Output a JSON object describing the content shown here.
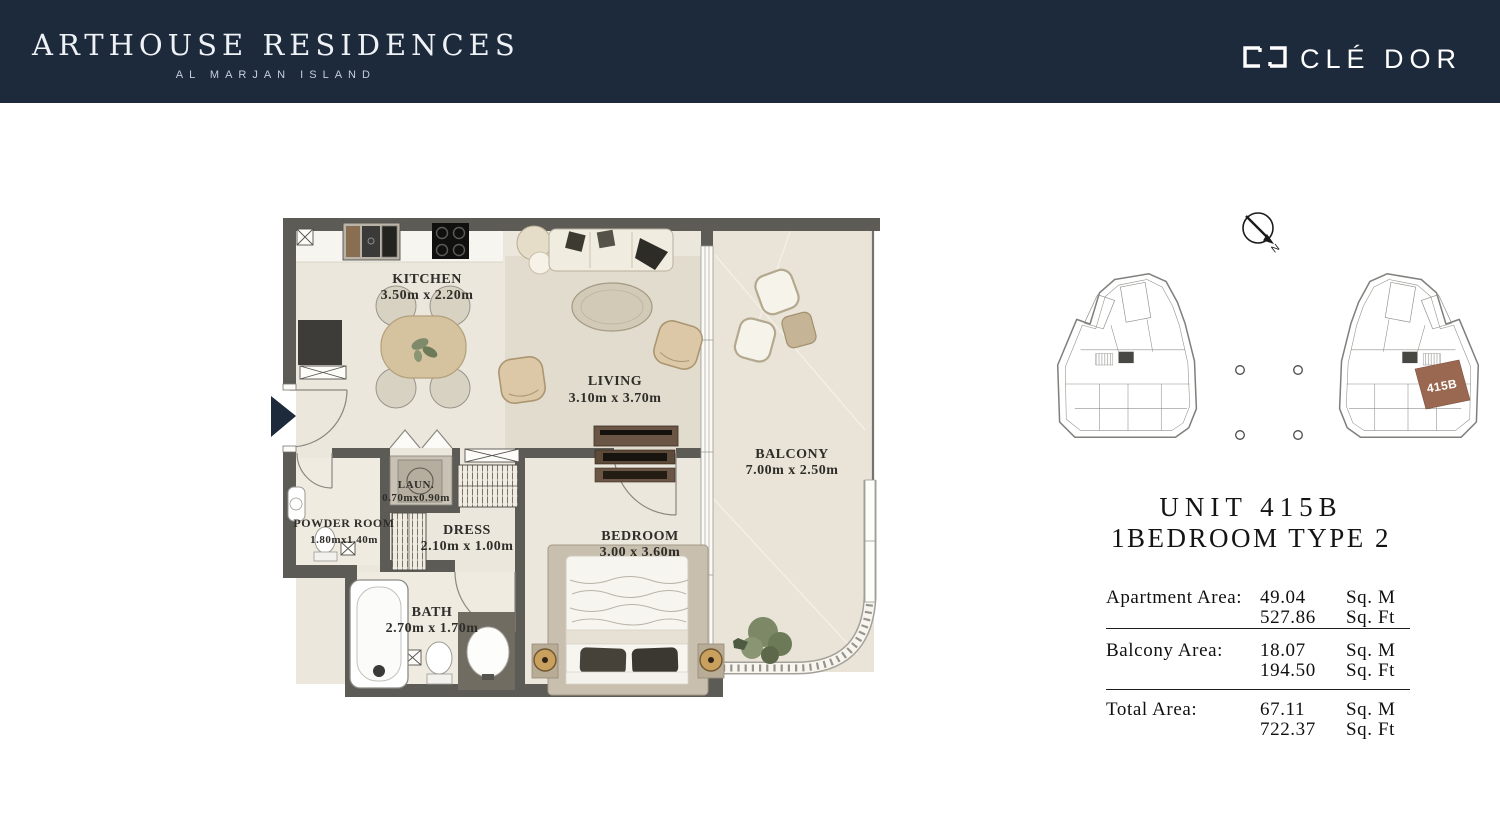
{
  "header": {
    "title": "ARTHOUSE RESIDENCES",
    "subtitle": "AL MARJAN ISLAND"
  },
  "brand": {
    "name": "CLÉ DOR"
  },
  "floorplan": {
    "compass_label": "N",
    "rooms": {
      "kitchen": {
        "name": "KITCHEN",
        "dims": "3.50m x 2.20m"
      },
      "living": {
        "name": "LIVING",
        "dims": "3.10m x 3.70m"
      },
      "balcony": {
        "name": "BALCONY",
        "dims": "7.00m x 2.50m"
      },
      "powder": {
        "name": "POWDER ROOM",
        "dims": "1.80mx1.40m"
      },
      "laundry": {
        "name": "LAUN.",
        "dims": "0.70mx0.90m"
      },
      "dress": {
        "name": "DRESS",
        "dims": "2.10m x 1.00m"
      },
      "bath": {
        "name": "BATH",
        "dims": "2.70m x 1.70m"
      },
      "bedroom": {
        "name": "BEDROOM",
        "dims": "3.00 x 3.60m"
      }
    }
  },
  "keyplan": {
    "highlight_label": "415B"
  },
  "unit": {
    "title": "UNIT 415B",
    "type": "1BEDROOM TYPE 2"
  },
  "areas": {
    "rows": [
      {
        "label": "Apartment Area:",
        "sqm": "49.04",
        "sqm_unit": "Sq. M",
        "sqft": "527.86",
        "sqft_unit": "Sq. Ft"
      },
      {
        "label": "Balcony Area:",
        "sqm": "18.07",
        "sqm_unit": "Sq. M",
        "sqft": "194.50",
        "sqft_unit": "Sq. Ft"
      },
      {
        "label": "Total Area:",
        "sqm": "67.11",
        "sqm_unit": "Sq. M",
        "sqft": "722.37",
        "sqft_unit": "Sq. Ft"
      }
    ]
  },
  "colors": {
    "navy": "#1d2a3b",
    "wall": "#5d5b56",
    "floor": "#ece7dc",
    "balcony_floor": "#e9e4d7",
    "highlight_brown": "#9a6750"
  }
}
